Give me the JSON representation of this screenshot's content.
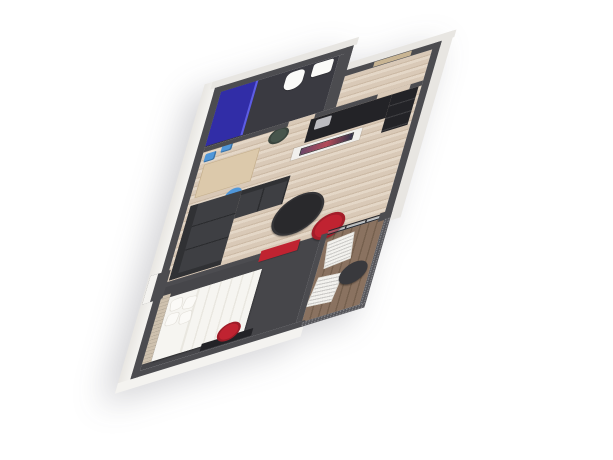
{
  "scene": {
    "description": "3D isometric render of a one-bedroom apartment floor plan on a white background",
    "view": "axonometric top-down, long axis tilted, no visible text"
  },
  "palette": {
    "page-bg": "#ffffff",
    "wall-top": "#4c4c50",
    "wall-face": "#f4f3f0",
    "wall-face-shade": "#e8e6e2",
    "floor-wood": "#d9c9b7",
    "floor-wood-dark": "#ccbaa6",
    "floor-wood-light": "#e4d7c7",
    "bathroom-floor": "#3a3a41",
    "carpet": "#46464a",
    "deck": "#8a7260",
    "deck-dark": "#75604e",
    "sofa": "#3e3f43",
    "sofa-dark": "#303134",
    "black-furniture": "#232327",
    "red-accent": "#c02331",
    "shower-blue": "rgba(47,42,196,0.78)",
    "shower-glass": "rgba(99,99,235,0.9)",
    "chair-blue": "#4f97da",
    "chair-green": "#47554c",
    "bed-white": "#f6f5f1",
    "bed-fold": "#e9e7e0",
    "headboard-wood": "#cec1ae",
    "appliance-silver": "#bcbcc0",
    "mesh": "#56565b",
    "glass": "rgba(150,170,185,0.4)",
    "glass-frame": "#28282c",
    "door-wood": "#c8b492",
    "table-dark": "#39393d",
    "tv-a": "#6a4668",
    "tv-b": "#b44b58",
    "tv-c": "#323249",
    "fixture-white": "#fbfbf9"
  },
  "rooms": {
    "bathroom": {
      "label": "bathroom with blue glass shower, toilet and washbasin, dark floor"
    },
    "entry": {
      "label": "entry hall with light wood floor and wooden entry door"
    },
    "living": {
      "label": "open living room and kitchen with light wood floor"
    },
    "bedroom": {
      "label": "bedroom with dark carpet, double bed and red accents"
    },
    "balcony": {
      "label": "balcony with wood decking and perforated metal railing"
    }
  },
  "furniture": {
    "shower": {
      "label": "shower enclosure with royal blue glass"
    },
    "toilet": {
      "label": "white toilet"
    },
    "sink": {
      "label": "white washbasin"
    },
    "kitchen_counter": {
      "label": "black kitchen counter"
    },
    "kitchen_appliance": {
      "label": "silver countertop appliance"
    },
    "kitchen_tall_unit": {
      "label": "tall black kitchen cabinet"
    },
    "tv_partition": {
      "label": "white half-height partition with mounted TV"
    },
    "tv_screen": {
      "label": "television showing colorful cityscape"
    },
    "wall_boxes": {
      "label": "blue wall-mounted storage boxes"
    },
    "desk": {
      "label": "wooden work desk"
    },
    "desk_chair": {
      "label": "blue desk chair"
    },
    "side_chair": {
      "label": "dark green round chair"
    },
    "sofa": {
      "label": "charcoal L-shaped sectional sofa"
    },
    "coffee_table": {
      "label": "round black coffee table"
    },
    "pouf": {
      "label": "round red pouf ottoman"
    },
    "wardrobe": {
      "label": "red wardrobe panel on bedroom wall"
    },
    "bed": {
      "label": "double bed with white bedding"
    },
    "pillows": {
      "label": "four white pillows"
    },
    "headboard": {
      "label": "light wood slat headboard wall"
    },
    "bedroom_chair": {
      "label": "round red chair"
    },
    "bedroom_desk": {
      "label": "small black desk"
    },
    "lounger_left": {
      "label": "white slatted lounge chair"
    },
    "lounger_right": {
      "label": "white slatted lounge chair"
    },
    "balcony_table": {
      "label": "round dark bistro table"
    },
    "entry_door": {
      "label": "wooden entry door"
    },
    "railing": {
      "label": "dark perforated metal balcony railing"
    },
    "glass_wall": {
      "label": "black-framed glass wall to balcony"
    }
  }
}
